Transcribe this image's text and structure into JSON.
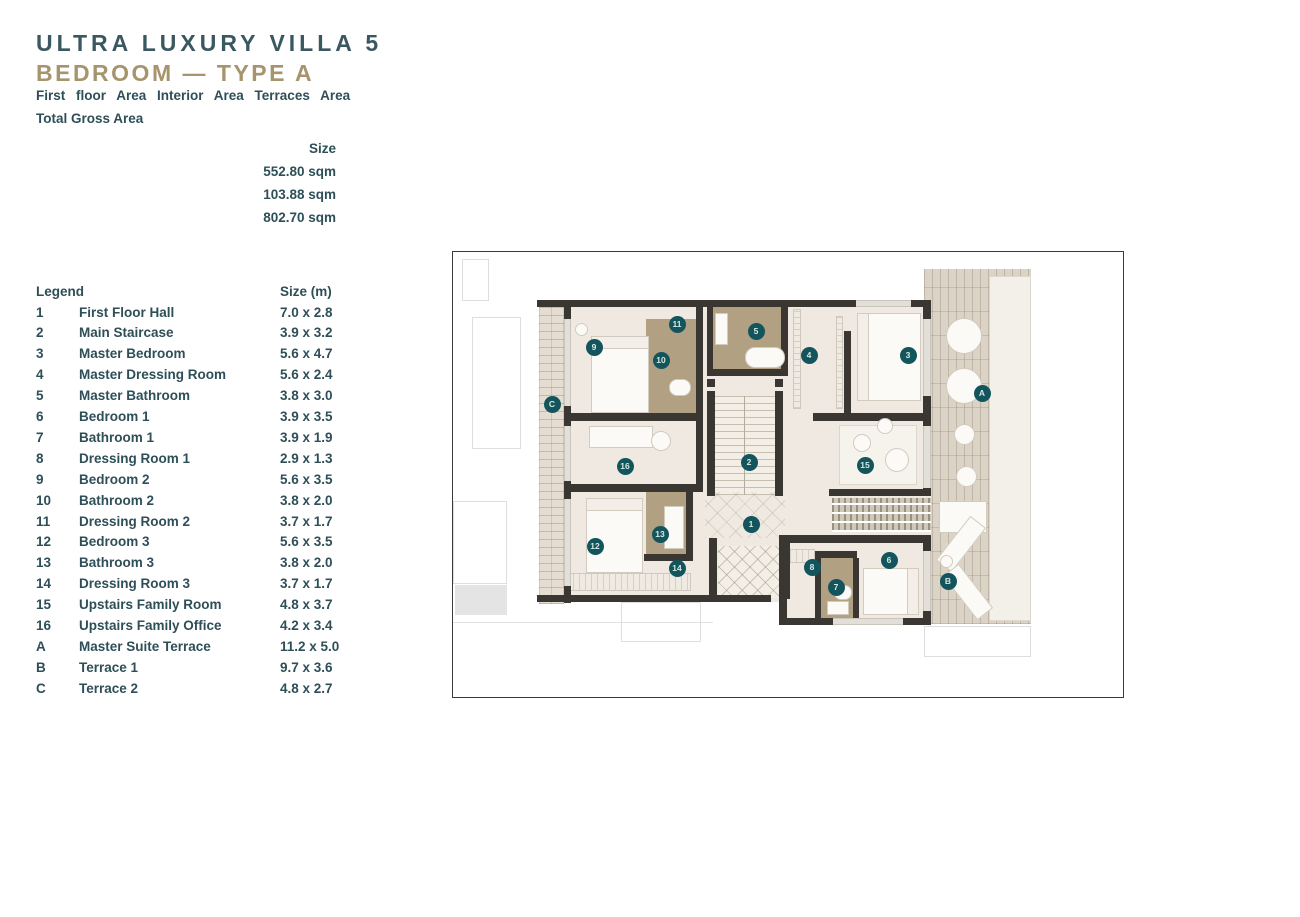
{
  "header": {
    "title_line1": "ULTRA LUXURY VILLA 5",
    "title_line2": "BEDROOM — TYPE A",
    "area_labels_line": "First floor Area Interior Area Terraces Area",
    "total_label": "Total Gross Area"
  },
  "area_summary": {
    "column_header": "Size",
    "values": [
      "552.80 sqm",
      "103.88 sqm",
      "802.70 sqm"
    ]
  },
  "legend": {
    "title": "Legend",
    "size_header": "Size (m)",
    "rows": [
      {
        "id": "1",
        "name": "First Floor Hall",
        "size": "7.0 x 2.8"
      },
      {
        "id": "2",
        "name": "Main Staircase",
        "size": "3.9 x 3.2"
      },
      {
        "id": "3",
        "name": "Master Bedroom",
        "size": "5.6 x 4.7"
      },
      {
        "id": "4",
        "name": "Master Dressing Room",
        "size": "5.6 x 2.4"
      },
      {
        "id": "5",
        "name": "Master Bathroom",
        "size": "3.8 x 3.0"
      },
      {
        "id": "6",
        "name": "Bedroom 1",
        "size": "3.9 x 3.5"
      },
      {
        "id": "7",
        "name": "Bathroom 1",
        "size": "3.9 x 1.9"
      },
      {
        "id": "8",
        "name": "Dressing Room 1",
        "size": "2.9 x 1.3"
      },
      {
        "id": "9",
        "name": "Bedroom 2",
        "size": "5.6 x 3.5"
      },
      {
        "id": "10",
        "name": "Bathroom 2",
        "size": "3.8 x 2.0"
      },
      {
        "id": "11",
        "name": "Dressing Room 2",
        "size": "3.7 x 1.7"
      },
      {
        "id": "12",
        "name": "Bedroom 3",
        "size": "5.6 x 3.5"
      },
      {
        "id": "13",
        "name": "Bathroom 3",
        "size": "3.8 x 2.0"
      },
      {
        "id": "14",
        "name": "Dressing Room 3",
        "size": "3.7 x 1.7"
      },
      {
        "id": "15",
        "name": "Upstairs Family Room",
        "size": "4.8 x 3.7"
      },
      {
        "id": "16",
        "name": "Upstairs Family Office",
        "size": "4.2 x 3.4"
      },
      {
        "id": "A",
        "name": "Master Suite Terrace",
        "size": "11.2 x 5.0"
      },
      {
        "id": "B",
        "name": "Terrace 1",
        "size": "9.7 x 3.6"
      },
      {
        "id": "C",
        "name": "Terrace 2",
        "size": "4.8 x 2.7"
      }
    ]
  },
  "plan": {
    "marker_color": "#14555d",
    "marker_text_color": "#d5eae2",
    "wall_color": "#3a3733",
    "bath_color": "#b2a083",
    "floor_color": "#efe9e1",
    "markers": [
      {
        "label": "1",
        "x": 298,
        "y": 272
      },
      {
        "label": "2",
        "x": 296,
        "y": 210
      },
      {
        "label": "3",
        "x": 455,
        "y": 103
      },
      {
        "label": "4",
        "x": 356,
        "y": 103
      },
      {
        "label": "5",
        "x": 303,
        "y": 79
      },
      {
        "label": "6",
        "x": 436,
        "y": 308
      },
      {
        "label": "7",
        "x": 383,
        "y": 335
      },
      {
        "label": "8",
        "x": 359,
        "y": 315
      },
      {
        "label": "9",
        "x": 141,
        "y": 95
      },
      {
        "label": "10",
        "x": 208,
        "y": 108
      },
      {
        "label": "11",
        "x": 224,
        "y": 72
      },
      {
        "label": "12",
        "x": 142,
        "y": 294
      },
      {
        "label": "13",
        "x": 207,
        "y": 282
      },
      {
        "label": "14",
        "x": 224,
        "y": 316
      },
      {
        "label": "15",
        "x": 412,
        "y": 213
      },
      {
        "label": "16",
        "x": 172,
        "y": 214
      },
      {
        "label": "A",
        "x": 529,
        "y": 141
      },
      {
        "label": "B",
        "x": 495,
        "y": 329
      },
      {
        "label": "C",
        "x": 99,
        "y": 152
      }
    ]
  }
}
